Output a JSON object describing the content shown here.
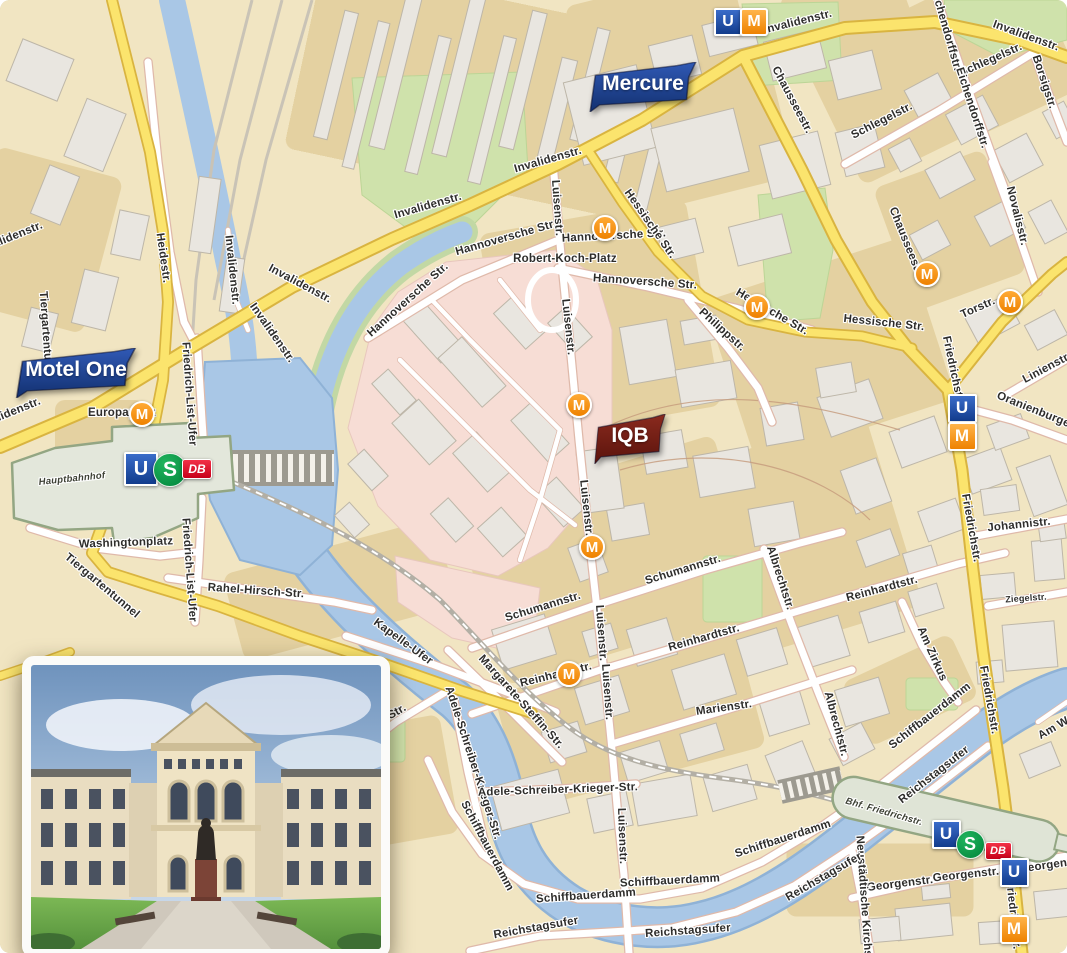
{
  "map": {
    "colors": {
      "bg": "#f1e5c2",
      "block": "#e3cf9d",
      "building": "#e9e6e0",
      "building_line": "#bdb6a8",
      "water": "#a9c7e6",
      "water_edge": "#8fb2d6",
      "park": "#cfe2ab",
      "campus_pink": "#f7ddd5",
      "road_major": "#fbe46d",
      "road_casing": "#d9b440",
      "street_casing": "#dfb9aa",
      "rail": "#b3afa5",
      "station_fill": "#e3e7db",
      "station_line": "#93a683",
      "label": "#2e2d2b",
      "flag_blue_1": "#3059b5",
      "flag_blue_2": "#12306f",
      "flag_red_1": "#8a2a1e",
      "flag_red_2": "#5a130c",
      "tram_orange": "#ee8200",
      "ubahn_blue": "#123c8c",
      "sbahn_green": "#00843a",
      "db_red": "#e2001a"
    },
    "flags": [
      {
        "label": "Mercure",
        "x": 586,
        "y": 62,
        "w": 114,
        "h": 50,
        "fs": 21,
        "c1": "#3059b5",
        "c2": "#12306f",
        "name": "flag-mercure"
      },
      {
        "label": "Motel One",
        "x": 12,
        "y": 348,
        "w": 128,
        "h": 50,
        "fs": 21,
        "c1": "#3059b5",
        "c2": "#12306f",
        "name": "flag-motel-one"
      },
      {
        "label": "IQB",
        "x": 592,
        "y": 414,
        "w": 76,
        "h": 50,
        "fs": 21,
        "c1": "#8a2a1e",
        "c2": "#5a130c",
        "name": "flag-iqb"
      }
    ],
    "transit_icons": [
      {
        "type": "u-square",
        "x": 726,
        "y": 20,
        "s": 24
      },
      {
        "type": "m-square",
        "x": 752,
        "y": 20,
        "s": 24
      },
      {
        "type": "m-circle",
        "x": 603,
        "y": 226,
        "s": 22
      },
      {
        "type": "m-circle",
        "x": 755,
        "y": 305,
        "s": 22
      },
      {
        "type": "m-circle",
        "x": 925,
        "y": 272,
        "s": 22
      },
      {
        "type": "m-circle",
        "x": 1008,
        "y": 300,
        "s": 22
      },
      {
        "type": "m-circle",
        "x": 140,
        "y": 412,
        "s": 22
      },
      {
        "type": "m-circle",
        "x": 577,
        "y": 403,
        "s": 22
      },
      {
        "type": "m-circle",
        "x": 590,
        "y": 545,
        "s": 22
      },
      {
        "type": "m-circle",
        "x": 567,
        "y": 672,
        "s": 22
      },
      {
        "type": "u-square",
        "x": 960,
        "y": 406,
        "s": 25
      },
      {
        "type": "m-square",
        "x": 960,
        "y": 434,
        "s": 25
      },
      {
        "type": "u-square",
        "x": 139,
        "y": 467,
        "s": 30
      },
      {
        "type": "s-circle",
        "x": 169,
        "y": 469,
        "s": 32
      },
      {
        "type": "db-badge",
        "x": 196,
        "y": 468,
        "w": 28,
        "h": 18
      },
      {
        "type": "u-square",
        "x": 944,
        "y": 832,
        "s": 25
      },
      {
        "type": "s-circle",
        "x": 969,
        "y": 843,
        "s": 27
      },
      {
        "type": "db-badge",
        "x": 997,
        "y": 850,
        "w": 25,
        "h": 16
      },
      {
        "type": "u-square",
        "x": 1012,
        "y": 870,
        "s": 25
      },
      {
        "type": "m-square",
        "x": 1012,
        "y": 927,
        "s": 25
      }
    ],
    "station_labels": [
      {
        "t": "Hauptbahnhof",
        "x": 72,
        "y": 479,
        "r": -6
      },
      {
        "t": "Bhf. Friedrichstr.",
        "x": 884,
        "y": 812,
        "r": 16
      }
    ],
    "street_labels": [
      {
        "t": "Invalidenstr.",
        "x": 798,
        "y": 22,
        "r": -14
      },
      {
        "t": "Invalidenstr.",
        "x": 1026,
        "y": 36,
        "r": 20
      },
      {
        "t": "Invalidenstr.",
        "x": 548,
        "y": 160,
        "r": -16
      },
      {
        "t": "Invalidenstr.",
        "x": 428,
        "y": 206,
        "r": -16
      },
      {
        "t": "Invalidenstr.",
        "x": 232,
        "y": 270,
        "r": 84
      },
      {
        "t": "Invalidenstr.",
        "x": 300,
        "y": 284,
        "r": 28
      },
      {
        "t": "Invalidenstr.",
        "x": 272,
        "y": 333,
        "r": 55
      },
      {
        "t": "Invalidenstr.",
        "x": 10,
        "y": 238,
        "r": -22
      },
      {
        "t": "Invalidenstr.",
        "x": 8,
        "y": 414,
        "r": -22
      },
      {
        "t": "Heidestr.",
        "x": 163,
        "y": 258,
        "r": 82
      },
      {
        "t": "Tiergartentunnel",
        "x": 46,
        "y": 338,
        "r": 86
      },
      {
        "t": "Tiergartentunnel",
        "x": 102,
        "y": 586,
        "r": 40
      },
      {
        "t": "Hannoversche Str.",
        "x": 506,
        "y": 238,
        "r": -16
      },
      {
        "t": "Hannoversche Str.",
        "x": 408,
        "y": 300,
        "r": -42
      },
      {
        "t": "Hannoversche Str.",
        "x": 614,
        "y": 236,
        "r": -3
      },
      {
        "t": "Hannoversche Str.",
        "x": 645,
        "y": 282,
        "r": 4
      },
      {
        "t": "Robert-Koch-Platz",
        "x": 565,
        "y": 259,
        "r": 0
      },
      {
        "t": "Hessische Str.",
        "x": 650,
        "y": 224,
        "r": 55
      },
      {
        "t": "Hessische Str.",
        "x": 772,
        "y": 312,
        "r": 30
      },
      {
        "t": "Hessische Str.",
        "x": 884,
        "y": 323,
        "r": 6
      },
      {
        "t": "Philippstr.",
        "x": 722,
        "y": 330,
        "r": 42
      },
      {
        "t": "Luisenstr.",
        "x": 557,
        "y": 208,
        "r": 86
      },
      {
        "t": "Luisenstr.",
        "x": 568,
        "y": 327,
        "r": 84
      },
      {
        "t": "Luisenstr.",
        "x": 586,
        "y": 508,
        "r": 84
      },
      {
        "t": "Luisenstr.",
        "x": 601,
        "y": 633,
        "r": 86
      },
      {
        "t": "Luisenstr.",
        "x": 607,
        "y": 692,
        "r": 86
      },
      {
        "t": "Luisenstr.",
        "x": 622,
        "y": 836,
        "r": 88
      },
      {
        "t": "Schumannstr.",
        "x": 543,
        "y": 607,
        "r": -17
      },
      {
        "t": "Schumannstr.",
        "x": 683,
        "y": 570,
        "r": -17
      },
      {
        "t": "Albrechtstr.",
        "x": 780,
        "y": 578,
        "r": 72
      },
      {
        "t": "Albrechtstr.",
        "x": 836,
        "y": 724,
        "r": 75
      },
      {
        "t": "Reinhardtstr.",
        "x": 556,
        "y": 675,
        "r": -14
      },
      {
        "t": "Reinhardtstr.",
        "x": 704,
        "y": 638,
        "r": -16
      },
      {
        "t": "Reinhardtstr.",
        "x": 882,
        "y": 589,
        "r": -15
      },
      {
        "t": "Marienstr.",
        "x": 724,
        "y": 708,
        "r": -8
      },
      {
        "t": "Am Zirkus",
        "x": 932,
        "y": 654,
        "r": 66
      },
      {
        "t": "Ziegelstr.",
        "x": 1026,
        "y": 598,
        "r": -4,
        "k": "sm"
      },
      {
        "t": "Johannistr.",
        "x": 1019,
        "y": 525,
        "r": -6
      },
      {
        "t": "Linienstr.",
        "x": 1047,
        "y": 368,
        "r": -28
      },
      {
        "t": "Oranienburger Str.",
        "x": 1046,
        "y": 415,
        "r": 22
      },
      {
        "t": "Torstr.",
        "x": 978,
        "y": 308,
        "r": -24
      },
      {
        "t": "Novalisstr.",
        "x": 1017,
        "y": 216,
        "r": 76
      },
      {
        "t": "Borsigstr.",
        "x": 1044,
        "y": 82,
        "r": 72
      },
      {
        "t": "Schlegelstr.",
        "x": 882,
        "y": 121,
        "r": -27
      },
      {
        "t": "Schlegelstr.",
        "x": 991,
        "y": 60,
        "r": -24
      },
      {
        "t": "Eichendorffstr.",
        "x": 946,
        "y": 30,
        "r": 74
      },
      {
        "t": "Eichendorffstr.",
        "x": 972,
        "y": 108,
        "r": 72
      },
      {
        "t": "Chausseestr.",
        "x": 792,
        "y": 100,
        "r": 62
      },
      {
        "t": "Chausseestr.",
        "x": 906,
        "y": 242,
        "r": 68
      },
      {
        "t": "Friedrichstr.",
        "x": 953,
        "y": 370,
        "r": 78
      },
      {
        "t": "Friedrichstr.",
        "x": 971,
        "y": 528,
        "r": 80
      },
      {
        "t": "Friedrichstr.",
        "x": 989,
        "y": 700,
        "r": 80
      },
      {
        "t": "Friedrichstr.",
        "x": 1013,
        "y": 915,
        "r": 84
      },
      {
        "t": "Georgenstr.",
        "x": 900,
        "y": 884,
        "r": -7
      },
      {
        "t": "Georgenstr.",
        "x": 966,
        "y": 875,
        "r": -6
      },
      {
        "t": "Georgenstr.",
        "x": 1052,
        "y": 865,
        "r": -8
      },
      {
        "t": "Neustädtische Kirchstr.",
        "x": 864,
        "y": 902,
        "r": 86
      },
      {
        "t": "Reichstagsufer",
        "x": 536,
        "y": 928,
        "r": -10
      },
      {
        "t": "Reichstagsufer",
        "x": 688,
        "y": 931,
        "r": -4
      },
      {
        "t": "Reichstagsufer",
        "x": 824,
        "y": 877,
        "r": -30
      },
      {
        "t": "Reichstagsufer",
        "x": 934,
        "y": 775,
        "r": -38
      },
      {
        "t": "Schiffbauerdamm",
        "x": 487,
        "y": 846,
        "r": 62
      },
      {
        "t": "Schiffbauerdamm",
        "x": 586,
        "y": 896,
        "r": -4
      },
      {
        "t": "Schiffbauerdamm",
        "x": 670,
        "y": 881,
        "r": -3
      },
      {
        "t": "Schiffbauerdamm",
        "x": 783,
        "y": 839,
        "r": -18
      },
      {
        "t": "Schiffbauerdamm",
        "x": 930,
        "y": 716,
        "r": -38
      },
      {
        "t": "Margarete-Steffin-Str.",
        "x": 521,
        "y": 702,
        "r": 48
      },
      {
        "t": "Adele-Schreiber-Krieger-Str.",
        "x": 473,
        "y": 763,
        "r": 72
      },
      {
        "t": "Adele-Schreiber-Krieger-Str.",
        "x": 558,
        "y": 790,
        "r": -2
      },
      {
        "t": "Kapelle-Ufer",
        "x": 403,
        "y": 642,
        "r": 36
      },
      {
        "t": "Rahel-Hirsch-Str.",
        "x": 256,
        "y": 591,
        "r": 4
      },
      {
        "t": "Washingtonplatz",
        "x": 126,
        "y": 543,
        "r": -2
      },
      {
        "t": "Friedrich-List-Ufer",
        "x": 189,
        "y": 394,
        "r": 86
      },
      {
        "t": "Friedrich-List-Ufer",
        "x": 189,
        "y": 570,
        "r": 86
      },
      {
        "t": "Europaplatz",
        "x": 122,
        "y": 413,
        "r": 0
      },
      {
        "t": "Konrad-Adenauer-Str.",
        "x": 352,
        "y": 738,
        "r": -30
      },
      {
        "t": "Am Weidendamm",
        "x": 1082,
        "y": 712,
        "r": -30
      }
    ]
  }
}
